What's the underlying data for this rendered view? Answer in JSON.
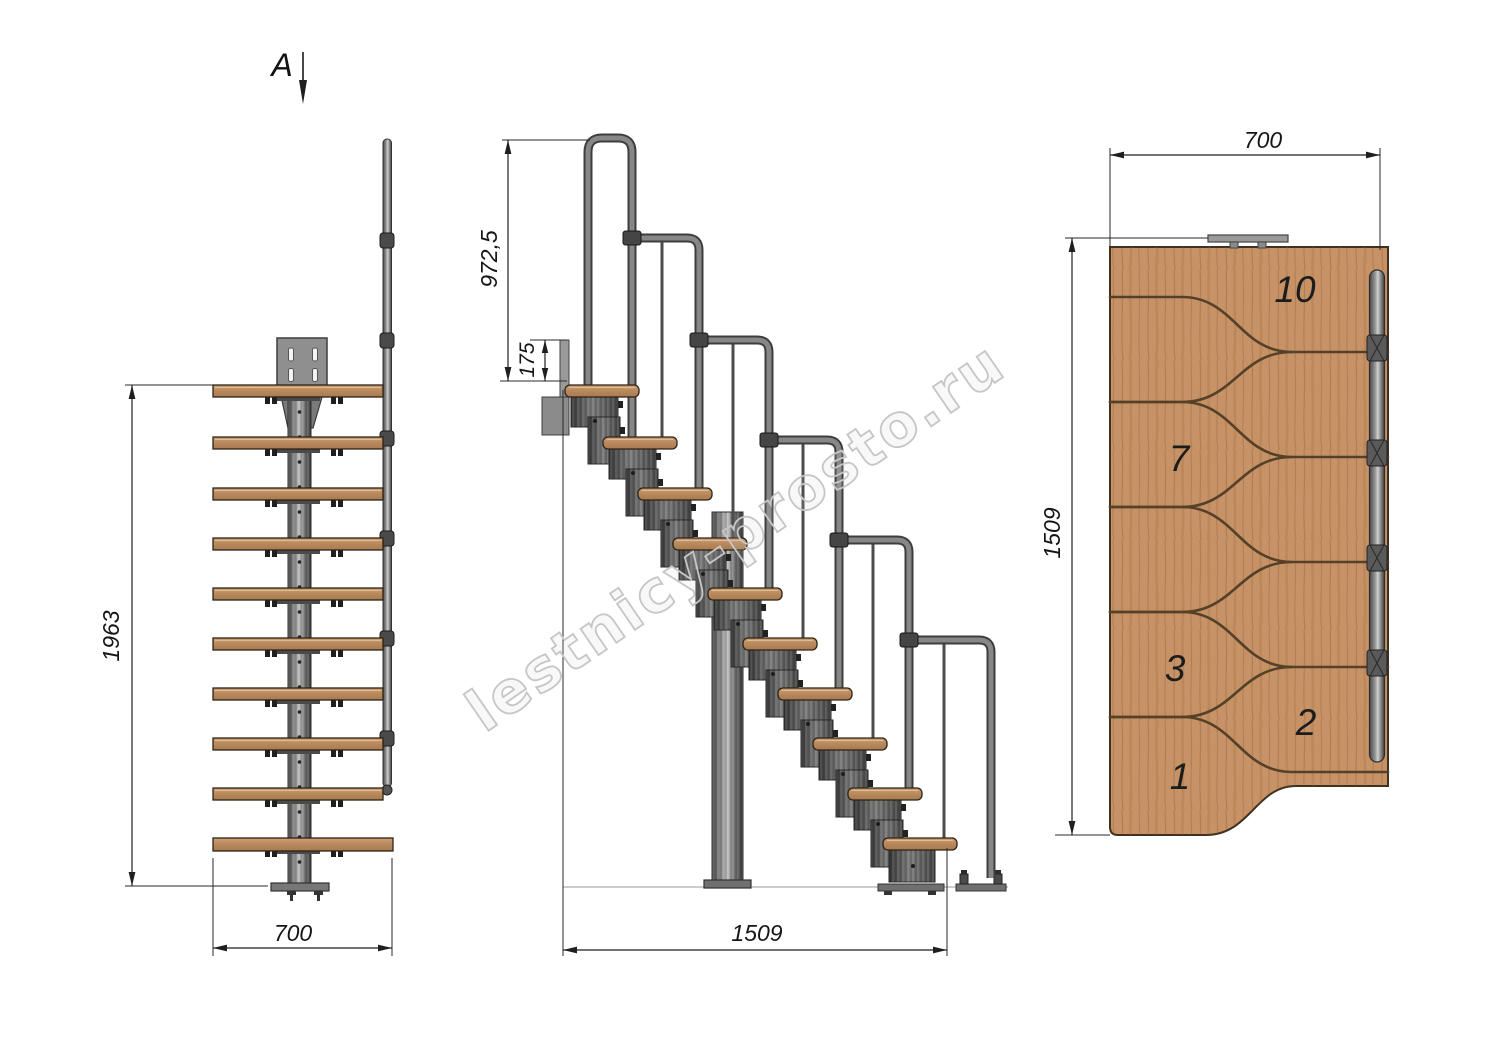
{
  "section_label": "A",
  "watermark": "lestnicy-prosto.ru",
  "front_view": {
    "height": "1963",
    "width": "700"
  },
  "side_view": {
    "handrail_height": "972,5",
    "rise": "175",
    "length": "1509"
  },
  "plan_view": {
    "width": "700",
    "depth": "1509",
    "step_numbers": [
      "10",
      "7",
      "3",
      "2",
      "1"
    ]
  },
  "colors": {
    "wood": "#c6926a",
    "metal": "#7d7d7d",
    "line": "#1f1f1f",
    "watermark": "#c6c6c6"
  }
}
